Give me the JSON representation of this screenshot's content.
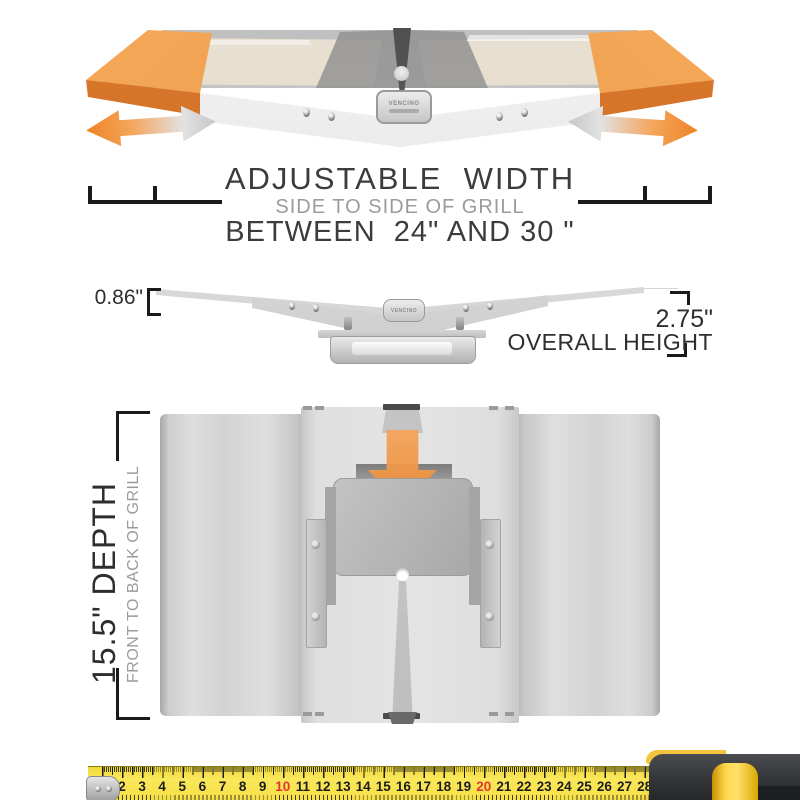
{
  "top_section": {
    "title": "ADJUSTABLE  WIDTH",
    "subtitle": "SIDE TO SIDE OF GRILL",
    "range": "BETWEEN  24\" AND 30 \""
  },
  "side_section": {
    "thickness": "0.86\"",
    "overall_height_value": "2.75\"",
    "overall_height_label": "OVERALL HEIGHT"
  },
  "depth_section": {
    "depth_label": "15.5\" DEPTH",
    "depth_sublabel": "FRONT TO BACK OF GRILL"
  },
  "brand": {
    "badge_text": "VENCINO"
  },
  "colors": {
    "accent_orange": "#EE8B33",
    "steel_gray": "#C9C9C9",
    "tape_yellow": "#F8E14B",
    "red_number": "#E0372E",
    "text_dark": "#3C3C3C",
    "text_gray": "#9B9B9B"
  },
  "ruler": {
    "numbers": [
      2,
      3,
      4,
      5,
      6,
      7,
      8,
      9,
      10,
      11,
      12,
      13,
      14,
      15,
      16,
      17,
      18,
      19,
      20,
      21,
      22,
      23,
      24,
      25,
      26,
      27,
      28
    ],
    "red_numbers": [
      10,
      20
    ]
  }
}
